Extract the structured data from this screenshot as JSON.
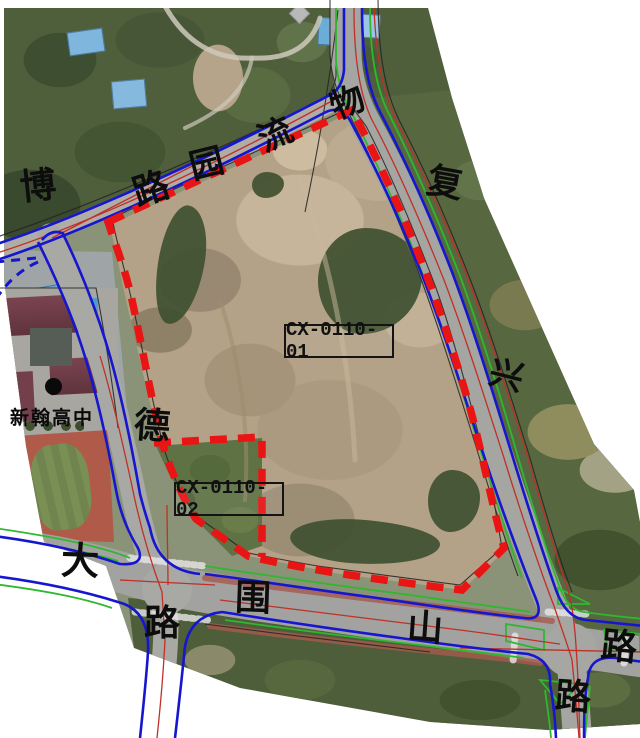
{
  "map": {
    "type": "aerial-planning-map",
    "parcel_labels": [
      {
        "id": "CX-0110-01"
      },
      {
        "id": "CX-0110-02"
      }
    ],
    "poi": {
      "school": "新翰高中"
    },
    "road_name_chars": [
      {
        "ch": "博"
      },
      {
        "ch": "路"
      },
      {
        "ch": "园"
      },
      {
        "ch": "流"
      },
      {
        "ch": "物"
      },
      {
        "ch": "复"
      },
      {
        "ch": "兴"
      },
      {
        "ch": "德"
      },
      {
        "ch": "大"
      },
      {
        "ch": "路"
      },
      {
        "ch": "围"
      },
      {
        "ch": "山"
      },
      {
        "ch": "路"
      },
      {
        "ch": "路"
      }
    ],
    "colors": {
      "boundary_dash": "#e91414",
      "road_edge_blue": "#1616cf",
      "green_line": "#2eb82e",
      "thin_red_line": "#c03028",
      "cadastral_black": "#222222"
    }
  }
}
